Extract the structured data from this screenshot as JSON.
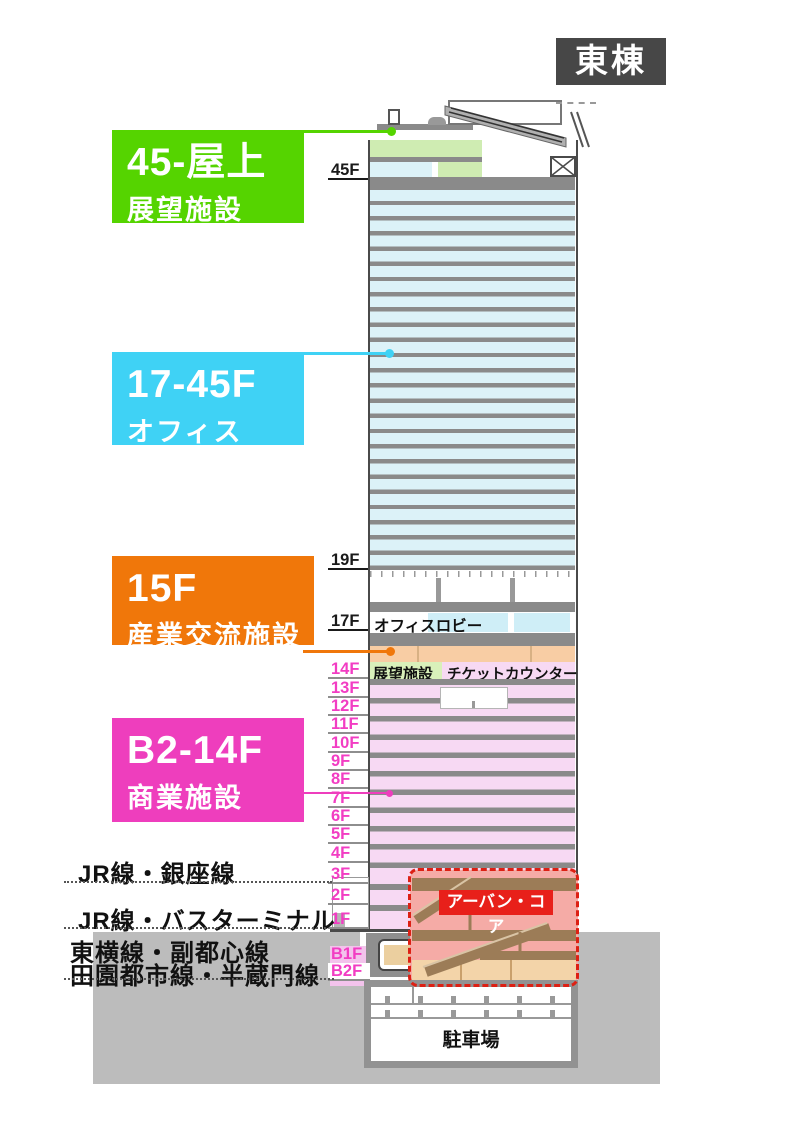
{
  "title": "東棟",
  "zones": [
    {
      "range": "45-屋上",
      "name": "展望施設",
      "color": "#55d400"
    },
    {
      "range": "17-45F",
      "name": "オフィス",
      "color": "#3fd2f5"
    },
    {
      "range": "15F",
      "name": "産業交流施設",
      "color": "#f0770a"
    },
    {
      "range": "B2-14F",
      "name": "商業施設",
      "color": "#ee3ebd"
    }
  ],
  "floors": [
    {
      "label": "45F"
    },
    {
      "label": "19F"
    },
    {
      "label": "17F"
    },
    {
      "label": "14F"
    },
    {
      "label": "13F"
    },
    {
      "label": "12F"
    },
    {
      "label": "11F"
    },
    {
      "label": "10F"
    },
    {
      "label": "9F"
    },
    {
      "label": "8F"
    },
    {
      "label": "7F"
    },
    {
      "label": "6F"
    },
    {
      "label": "5F"
    },
    {
      "label": "4F"
    },
    {
      "label": "3F"
    },
    {
      "label": "2F"
    },
    {
      "label": "1F"
    },
    {
      "label": "B1F"
    },
    {
      "label": "B2F"
    }
  ],
  "annotations": {
    "office_lobby": "オフィスロビー",
    "observatory": "展望施設",
    "ticket_counter": "チケットカウンター",
    "urban_core": "アーバン・コア",
    "parking": "駐車場"
  },
  "transit": [
    {
      "text": "JR線・銀座線"
    },
    {
      "text": "JR線・バスターミナル"
    },
    {
      "text": "東横線・副都心線"
    },
    {
      "text": "田園都市線・半蔵門線"
    }
  ],
  "colors": {
    "observatory_green": "#55d400",
    "office_cyan": "#3fd2f5",
    "industry_orange": "#f0770a",
    "retail_magenta": "#ee3ebd",
    "floor_label_magenta": "#f23dc3",
    "urban_core_red": "#e8201a",
    "office_band": "#dcf2f8",
    "retail_band": "#f7d9f3",
    "slab_gray": "#8a8a8a",
    "earth_gray": "#bcbcbc",
    "title_bg": "#474747"
  }
}
